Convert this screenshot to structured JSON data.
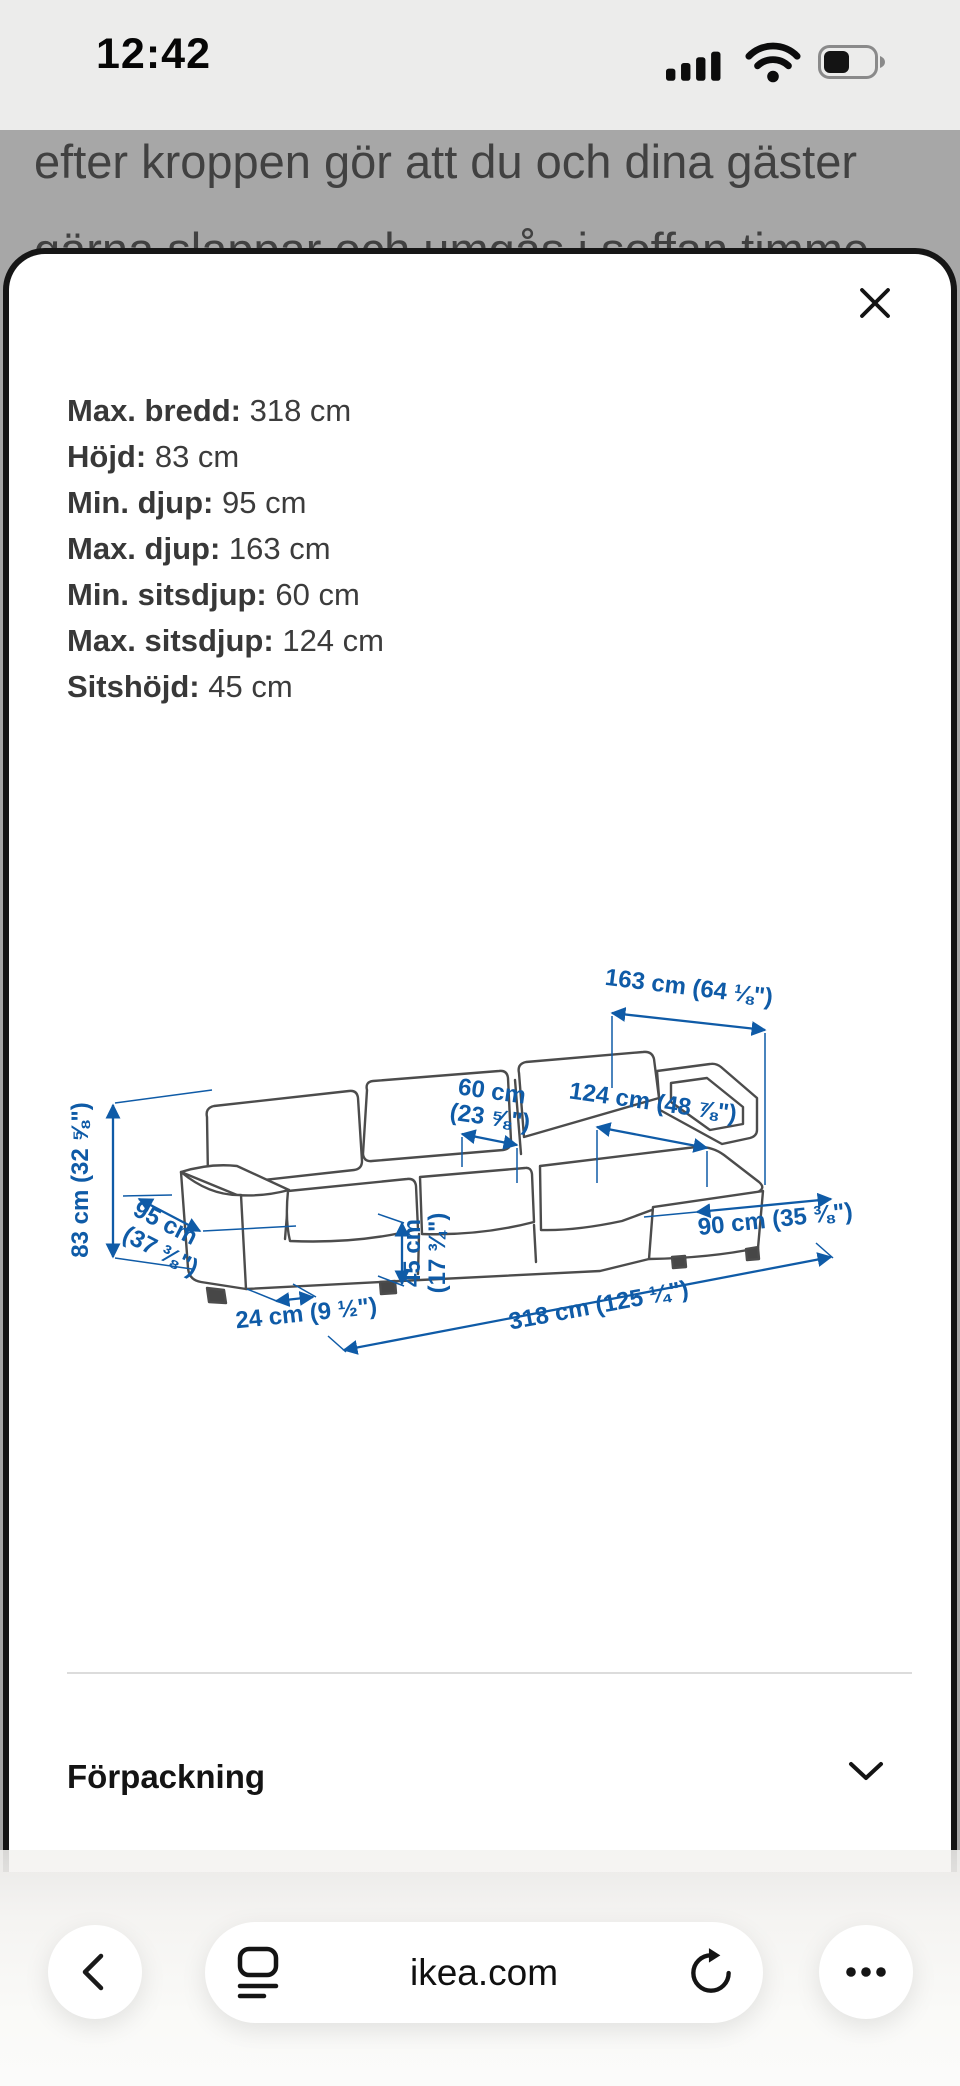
{
  "status_bar": {
    "time": "12:42",
    "icons": [
      "signal-icon",
      "wifi-icon",
      "battery-icon"
    ],
    "battery_level_percent": 40
  },
  "background_page": {
    "line1": "efter kroppen gör att du och dina gäster",
    "line2": "gärna slappar och umgås i soffan timme"
  },
  "modal": {
    "close_icon": "close-x",
    "measurements": [
      {
        "label": "Max. bredd:",
        "value": "318 cm"
      },
      {
        "label": "Höjd:",
        "value": "83 cm"
      },
      {
        "label": "Min. djup:",
        "value": "95 cm"
      },
      {
        "label": "Max. djup:",
        "value": "163 cm"
      },
      {
        "label": "Min. sitsdjup:",
        "value": "60 cm"
      },
      {
        "label": "Max. sitsdjup:",
        "value": "124 cm"
      },
      {
        "label": "Sitshöjd:",
        "value": "45 cm"
      }
    ],
    "diagram": {
      "type": "sofa-dimension-line-art",
      "labels": {
        "d163": "163 cm (64 ⅛\")",
        "d124": "124 cm (48 ⅞\")",
        "d60_1": "60 cm",
        "d60_2": "(23 ⅝\")",
        "d83": "83 cm (32 ⅝\")",
        "d95_1": "95 cm",
        "d95_2": "(37 ⅜\")",
        "d45_1": "45 cm",
        "d45_2": "(17 ¾\")",
        "d24": "24 cm (9 ½\")",
        "d318": "318 cm (125 ¼\")",
        "d90": "90 cm (35 ⅜\")"
      }
    },
    "packaging": {
      "label": "Förpackning"
    }
  },
  "browser_bar": {
    "url": "ikea.com",
    "icons": [
      "back-chevron",
      "reader-view",
      "refresh",
      "more-dots"
    ]
  },
  "colors": {
    "accent_blue": "#0f5ba7",
    "modal_border": "#161616",
    "scrim": "#a7a7a7",
    "status_bg": "#ececeb"
  }
}
